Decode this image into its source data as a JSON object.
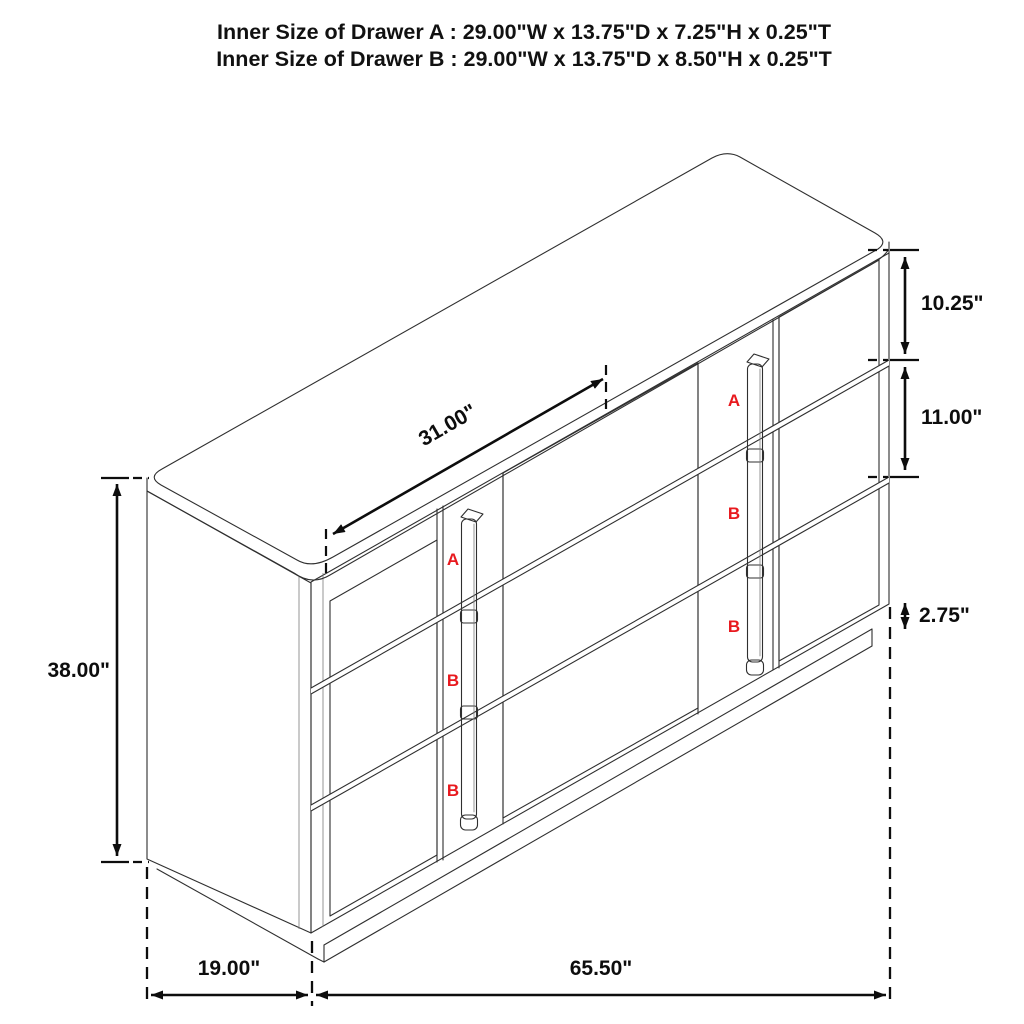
{
  "title": {
    "line1": "Inner Size of Drawer A : 29.00\"W x 13.75\"D x 7.25\"H x 0.25\"T",
    "line2": "Inner Size of Drawer B : 29.00\"W x 13.75\"D x 8.50\"H x 0.25\"T"
  },
  "dims": {
    "overall_height": "38.00\"",
    "drawer_a_height": "10.25\"",
    "drawer_b_height": "11.00\"",
    "base_height": "2.75\"",
    "depth": "19.00\"",
    "width": "65.50\"",
    "opening_width": "31.00\""
  },
  "drawer_labels": {
    "left_column": [
      "A",
      "B",
      "B"
    ],
    "right_column": [
      "A",
      "B",
      "B"
    ]
  },
  "colors": {
    "label_red": "#e8191e",
    "outline": "#2f2f2f",
    "dimension": "#0d0d0d",
    "background": "#ffffff"
  }
}
